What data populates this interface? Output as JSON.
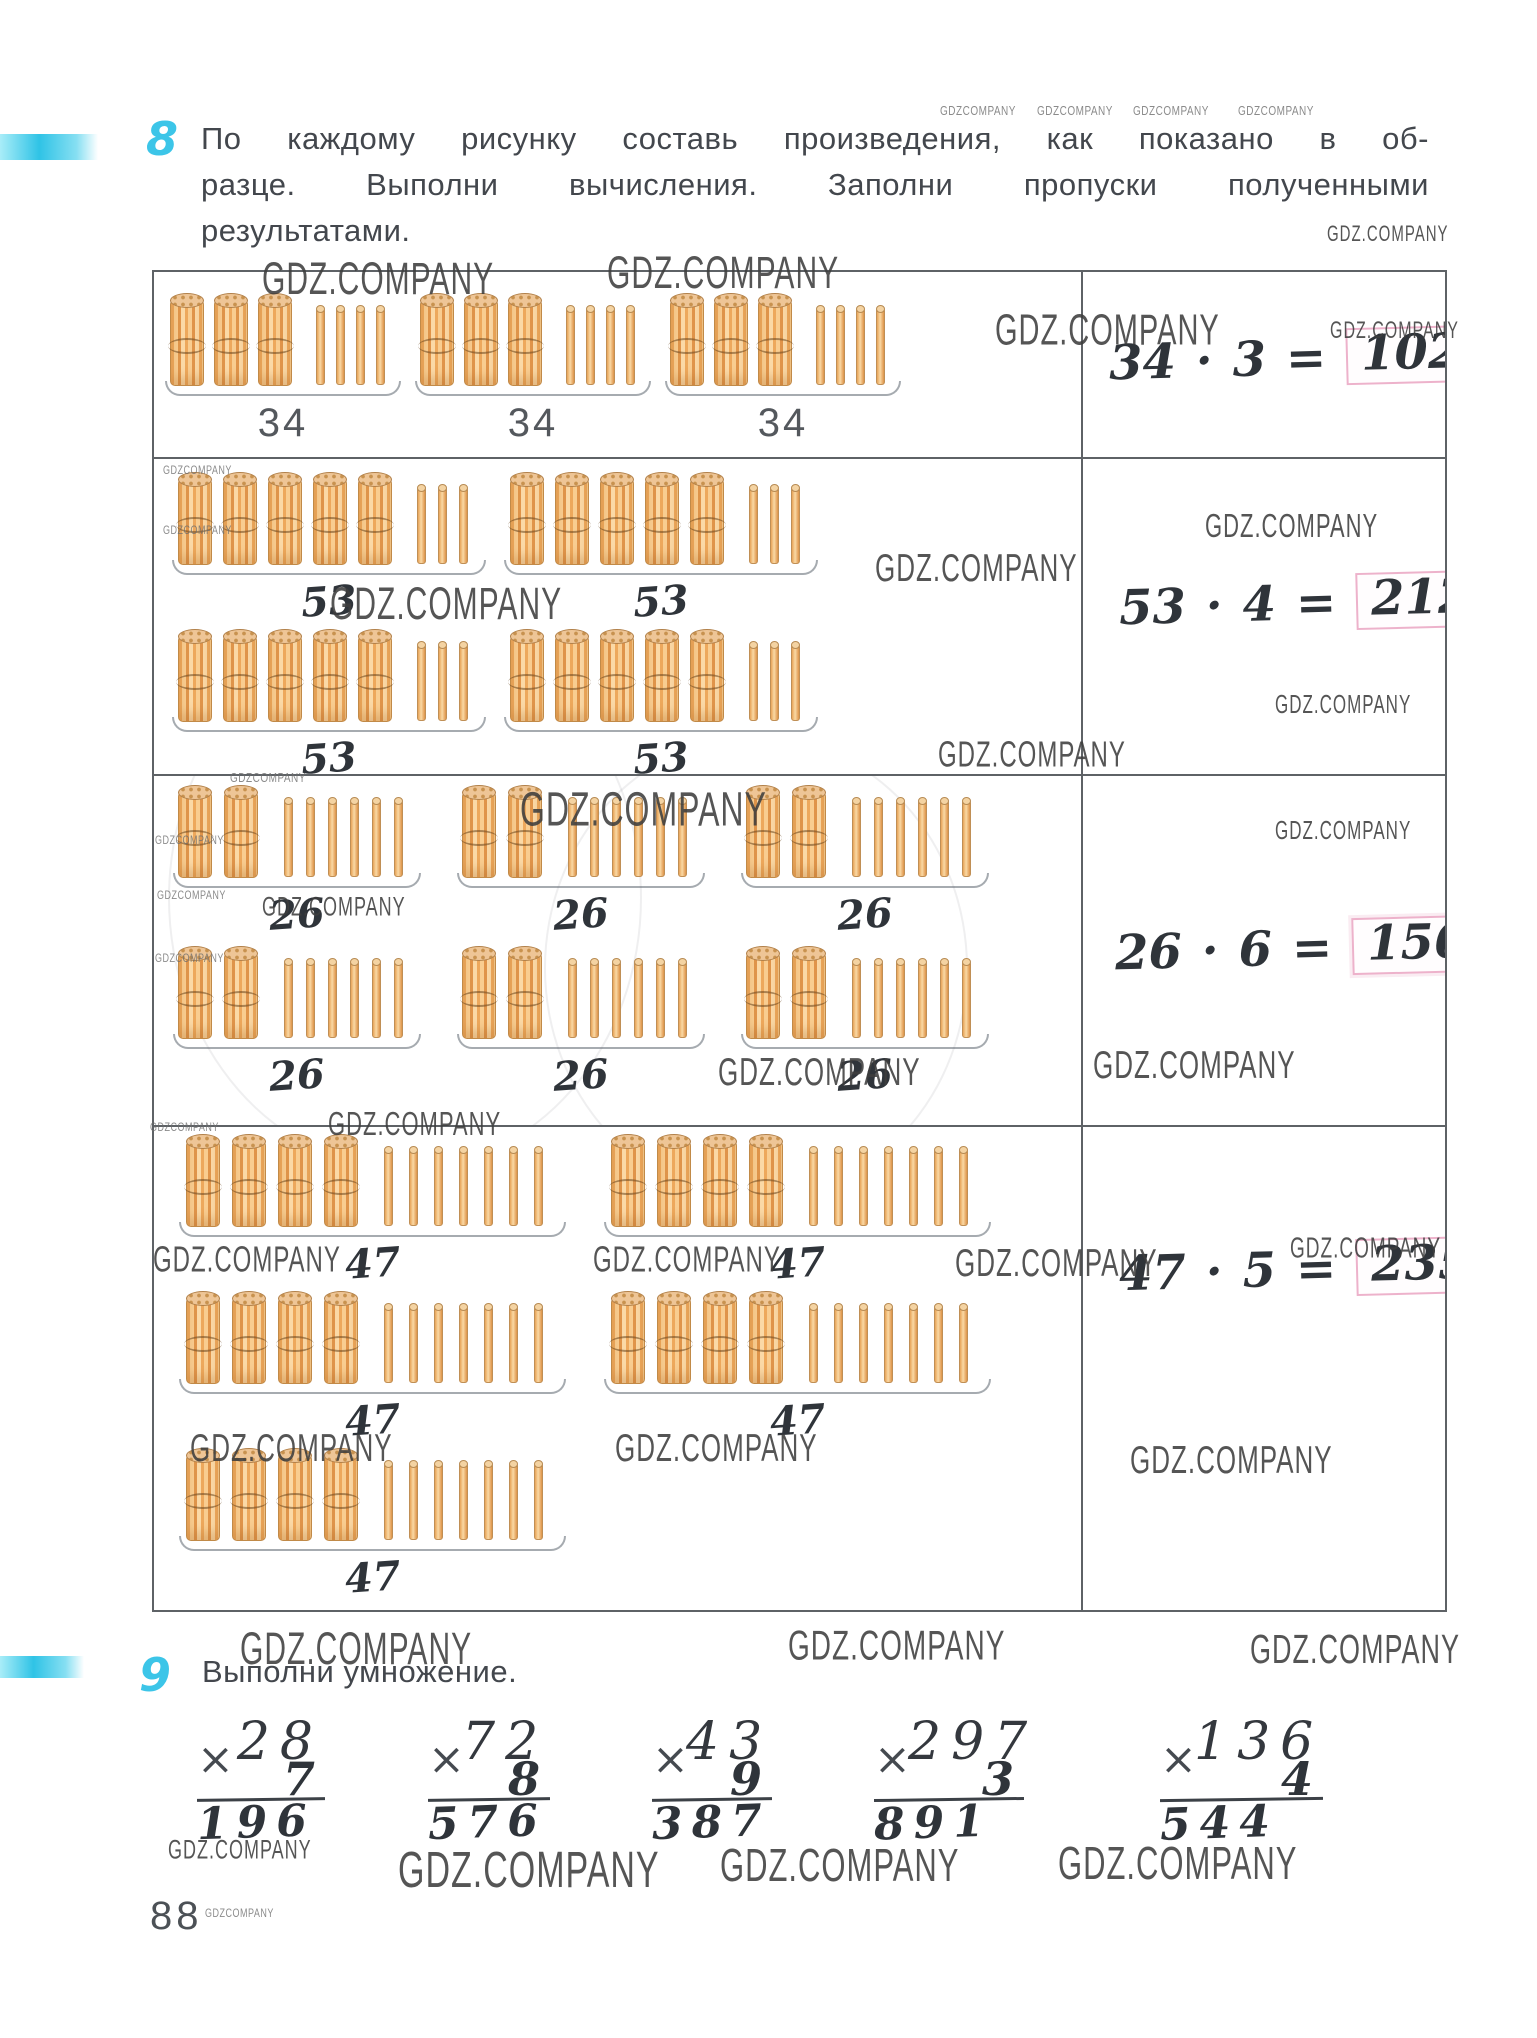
{
  "page": {
    "number": "88",
    "watermark": "GDZ.COMPANY",
    "watermark_small": "GDZCOMPANY"
  },
  "exercise8": {
    "number": "8",
    "instruction_lines": [
      "По каждому рисунку составь произведения, как показано в об-",
      "разце. Выполни вычисления. Заполни пропуски полученными",
      "результатами."
    ],
    "rows": [
      {
        "factor": "34",
        "bundles_per_group": 3,
        "singles_per_group": 4,
        "groups_per_line": [
          3
        ],
        "label_style": "printed",
        "equation": {
          "multiplicand": "34",
          "dot": "·",
          "multiplier": "3",
          "equals": "=",
          "product": "102"
        }
      },
      {
        "factor": "53",
        "bundles_per_group": 5,
        "singles_per_group": 3,
        "groups_per_line": [
          2,
          2
        ],
        "label_style": "handwritten",
        "equation": {
          "multiplicand": "53",
          "dot": "·",
          "multiplier": "4",
          "equals": "=",
          "product": "212"
        }
      },
      {
        "factor": "26",
        "bundles_per_group": 2,
        "singles_per_group": 6,
        "groups_per_line": [
          3,
          3
        ],
        "label_style": "handwritten",
        "equation": {
          "multiplicand": "26",
          "dot": "·",
          "multiplier": "6",
          "equals": "=",
          "product": "156"
        }
      },
      {
        "factor": "47",
        "bundles_per_group": 4,
        "singles_per_group": 7,
        "groups_per_line": [
          2,
          2,
          1
        ],
        "label_style": "handwritten",
        "equation": {
          "multiplicand": "47",
          "dot": "·",
          "multiplier": "5",
          "equals": "=",
          "product": "235"
        }
      }
    ]
  },
  "exercise9": {
    "number": "9",
    "title": "Выполни умножение.",
    "problems": [
      {
        "sign": "×",
        "multiplicand": "28",
        "multiplier": "7",
        "product": "196"
      },
      {
        "sign": "×",
        "multiplicand": "72",
        "multiplier": "8",
        "product": "576"
      },
      {
        "sign": "×",
        "multiplicand": "43",
        "multiplier": "9",
        "product": "387"
      },
      {
        "sign": "×",
        "multiplicand": "297",
        "multiplier": "3",
        "product": "891"
      },
      {
        "sign": "×",
        "multiplicand": "136",
        "multiplier": "4",
        "product": "544"
      }
    ]
  },
  "colors": {
    "accent_cyan": "#3cc5e8",
    "answer_box_border": "#edb2cb",
    "stick_light": "#fbd9a6",
    "stick_dark": "#e0954b",
    "text": "#43474d"
  }
}
